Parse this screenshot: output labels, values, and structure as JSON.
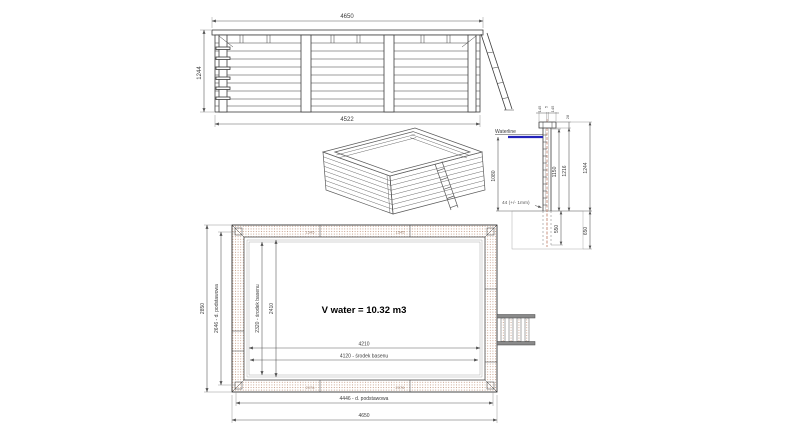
{
  "meta": {
    "background": "#ffffff",
    "line_color": "#3d3d3d",
    "waterline_blue": "#2323bb",
    "hatch_dot_color": "#c49a83",
    "centerline_red": "#b4654a"
  },
  "elevation": {
    "dim_top_width": "4650",
    "dim_left_height": "1244",
    "dim_bottom_width": "4522"
  },
  "section": {
    "waterline_label": "Waterline",
    "dim_cap_left": "145",
    "dim_cap_gap": "5",
    "dim_cap_right": "145",
    "dim_cap_thickness": "28",
    "dim_water_height": "1080",
    "dim_wall_1150": "1150",
    "dim_wall_1216": "1216",
    "dim_wall_total": "1244",
    "dim_plank_thickness": "44 (+/- 1mm)",
    "dim_embed_depth": "550",
    "dim_foundation": "650"
  },
  "plan": {
    "volume_label": "V water = 10.32 m3",
    "dim_outer_width": "4650",
    "dim_base_width": "4446 - d. podstawowa",
    "dim_outer_height": "2850",
    "dim_base_height": "2646 - d. podstawowa",
    "dim_inner_width": "4210",
    "dim_center_width": "4120 - środek basenu",
    "dim_inner_height": "2410",
    "dim_center_height": "2320 - środek basenu",
    "plank_labels_top": [
      "1545",
      "1545"
    ],
    "plank_labels_bottom": [
      "2076",
      "2076"
    ]
  }
}
